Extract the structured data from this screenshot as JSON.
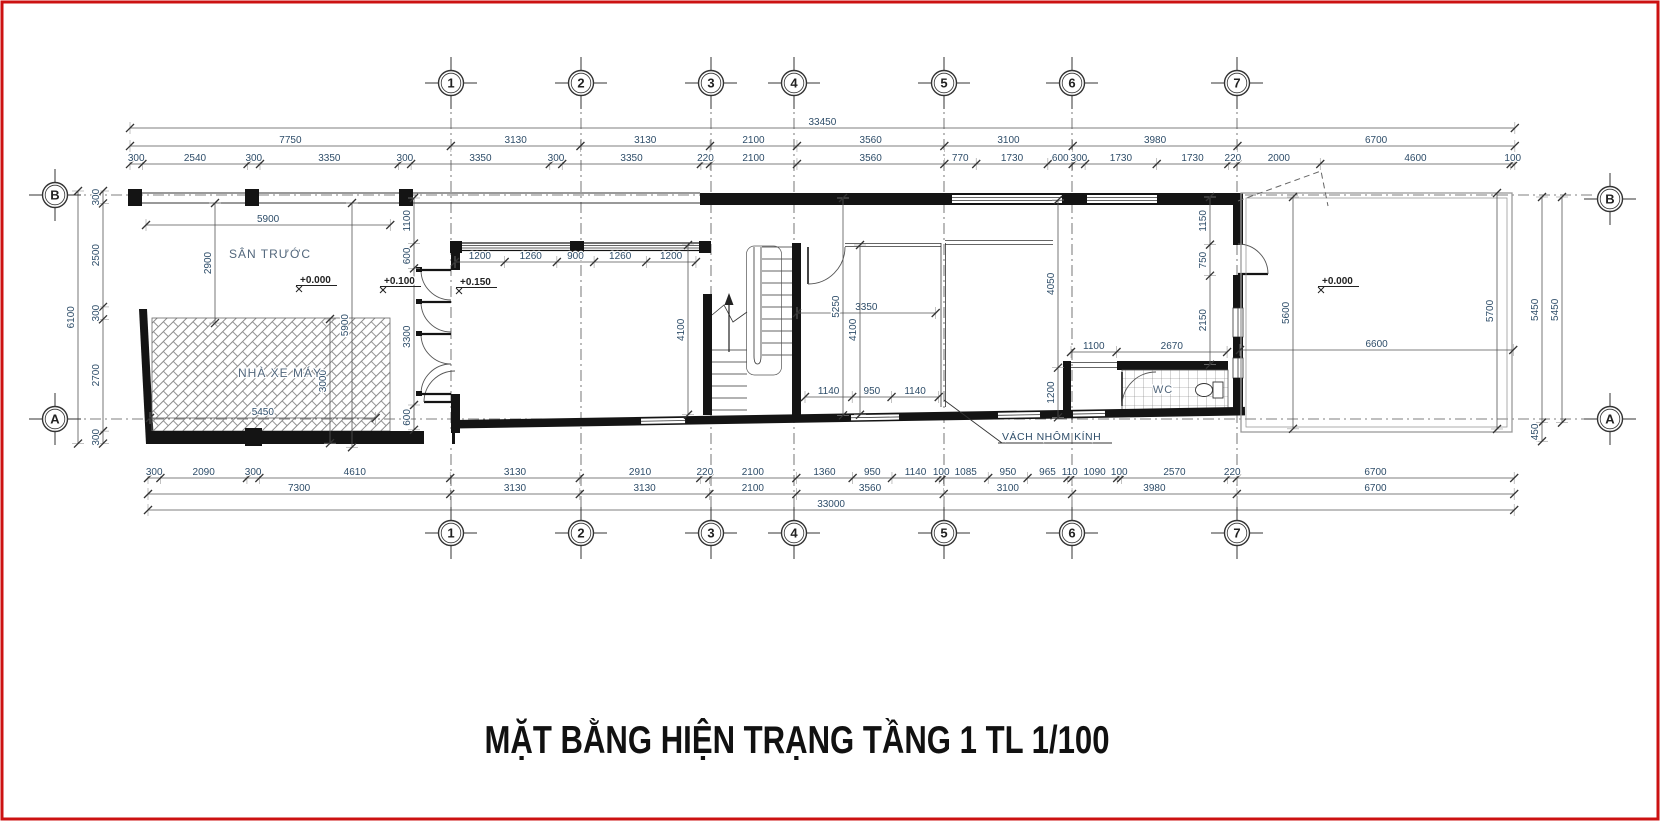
{
  "title": "MẶT BẰNG HIỆN TRẠNG TẦNG 1 TL 1/100",
  "drawing_type": "floor-plan",
  "scale_px_per_mm": 0.0414,
  "colors": {
    "page_border": "#cc1111",
    "wall": "#141414",
    "dim_text": "#2e4d69",
    "label_text": "#52677c",
    "grid_line": "#555555"
  },
  "grid_bubbles": {
    "top": {
      "y": 83,
      "items": [
        {
          "label": "1",
          "x": 451
        },
        {
          "label": "2",
          "x": 581
        },
        {
          "label": "3",
          "x": 711
        },
        {
          "label": "4",
          "x": 794
        },
        {
          "label": "5",
          "x": 944
        },
        {
          "label": "6",
          "x": 1072
        },
        {
          "label": "7",
          "x": 1237
        }
      ]
    },
    "bottom": {
      "y": 533,
      "items": [
        {
          "label": "1",
          "x": 451
        },
        {
          "label": "2",
          "x": 581
        },
        {
          "label": "3",
          "x": 711
        },
        {
          "label": "4",
          "x": 794
        },
        {
          "label": "5",
          "x": 944
        },
        {
          "label": "6",
          "x": 1072
        },
        {
          "label": "7",
          "x": 1237
        }
      ]
    },
    "left": {
      "x": 55,
      "items": [
        {
          "label": "B",
          "y": 195
        },
        {
          "label": "A",
          "y": 419
        }
      ]
    },
    "right": {
      "x": 1610,
      "items": [
        {
          "label": "B",
          "y": 199
        },
        {
          "label": "A",
          "y": 419
        }
      ]
    }
  },
  "h_chains": [
    {
      "name": "top-total",
      "y": 128,
      "x0": 130,
      "values": [
        33450
      ]
    },
    {
      "name": "top-major",
      "y": 146,
      "x0": 130,
      "values": [
        7750,
        3130,
        3130,
        2100,
        3560,
        3100,
        3980,
        6700
      ]
    },
    {
      "name": "top-minor",
      "y": 164,
      "x0": 130,
      "values": [
        300,
        2540,
        300,
        3350,
        300,
        3350,
        300,
        3350,
        220,
        2100,
        3560,
        770,
        1730,
        600,
        300,
        1730,
        1730,
        220,
        2000,
        4600,
        100
      ]
    },
    {
      "name": "yard-5900",
      "y": 225,
      "x0": 146,
      "values": [
        5900
      ]
    },
    {
      "name": "windows",
      "y": 262,
      "x0": 455,
      "values": [
        1200,
        1260,
        900,
        1260,
        1200
      ]
    },
    {
      "name": "room-3350",
      "y": 313,
      "x0": 797,
      "values": [
        3350
      ]
    },
    {
      "name": "wc-top",
      "y": 352,
      "x0": 1071,
      "values": [
        1100,
        2670
      ]
    },
    {
      "name": "porch-6600",
      "y": 350,
      "x0": 1240,
      "values": [
        6600
      ]
    },
    {
      "name": "room-glass",
      "y": 397,
      "x0": 805,
      "values": [
        1140,
        950,
        1140
      ]
    },
    {
      "name": "garage-5450",
      "y": 418,
      "x0": 150,
      "values": [
        5450
      ]
    },
    {
      "name": "bot-minor",
      "y": 478,
      "x0": 148,
      "values": [
        300,
        2090,
        300,
        4610,
        3130,
        2910,
        220,
        2100,
        1360,
        950,
        1140,
        100,
        1085,
        950,
        965,
        110,
        1090,
        100,
        2570,
        220,
        6700
      ]
    },
    {
      "name": "bot-major",
      "y": 494,
      "x0": 148,
      "values": [
        7300,
        3130,
        3130,
        2100,
        3560,
        3100,
        3980,
        6700
      ]
    },
    {
      "name": "bot-total",
      "y": 510,
      "x0": 148,
      "values": [
        33000
      ]
    }
  ],
  "v_chains": [
    {
      "name": "left-total",
      "x": 78,
      "y0": 191,
      "values": [
        6100
      ]
    },
    {
      "name": "left-minor",
      "x": 103,
      "y0": 191,
      "values": [
        300,
        2500,
        300,
        2700,
        300
      ]
    },
    {
      "name": "yard-2900",
      "x": 215,
      "y0": 203,
      "values": [
        2900
      ]
    },
    {
      "name": "garage-3000",
      "x": 330,
      "y0": 319,
      "values": [
        3000
      ]
    },
    {
      "name": "garage-5900",
      "x": 352,
      "y0": 203,
      "values": [
        5900
      ]
    },
    {
      "name": "room1-chain",
      "x": 414,
      "y0": 198,
      "values": [
        1100,
        600,
        3300,
        600
      ]
    },
    {
      "name": "room1-4100",
      "x": 688,
      "y0": 245,
      "values": [
        4100
      ]
    },
    {
      "name": "stair-5250",
      "x": 843,
      "y0": 198,
      "values": [
        5250
      ]
    },
    {
      "name": "stair-4100",
      "x": 860,
      "y0": 245,
      "values": [
        4100
      ]
    },
    {
      "name": "wc-4050",
      "x": 1058,
      "y0": 200,
      "values": [
        4050,
        1200
      ]
    },
    {
      "name": "door7-chain",
      "x": 1210,
      "y0": 197,
      "values": [
        1150,
        750,
        2150
      ]
    },
    {
      "name": "porch-5600",
      "x": 1293,
      "y0": 197,
      "values": [
        5600
      ]
    },
    {
      "name": "porch-5700",
      "x": 1497,
      "y0": 193,
      "values": [
        5700
      ]
    },
    {
      "name": "right-inner",
      "x": 1542,
      "y0": 197,
      "values": [
        5450,
        450
      ]
    },
    {
      "name": "right-outer",
      "x": 1562,
      "y0": 197,
      "values": [
        5450
      ]
    }
  ],
  "room_labels": [
    {
      "text": "SÂN TRƯỚC",
      "x": 270,
      "y": 258,
      "size": 12
    },
    {
      "text": "NHÀ XE MÁY",
      "x": 280,
      "y": 377,
      "size": 12
    },
    {
      "text": "WC",
      "x": 1163,
      "y": 393,
      "size": 11
    }
  ],
  "level_markers": [
    {
      "text": "+0.000",
      "x": 300,
      "y": 283
    },
    {
      "text": "+0.100",
      "x": 384,
      "y": 284
    },
    {
      "text": "+0.150",
      "x": 460,
      "y": 285
    },
    {
      "text": "+0.000",
      "x": 1322,
      "y": 284
    }
  ],
  "callout": {
    "text": "VÁCH NHÔM KÍNH",
    "text_x": 1002,
    "text_y": 440,
    "underline_x2": 1112,
    "leader": [
      [
        944,
        400
      ],
      [
        1002,
        443
      ]
    ]
  }
}
